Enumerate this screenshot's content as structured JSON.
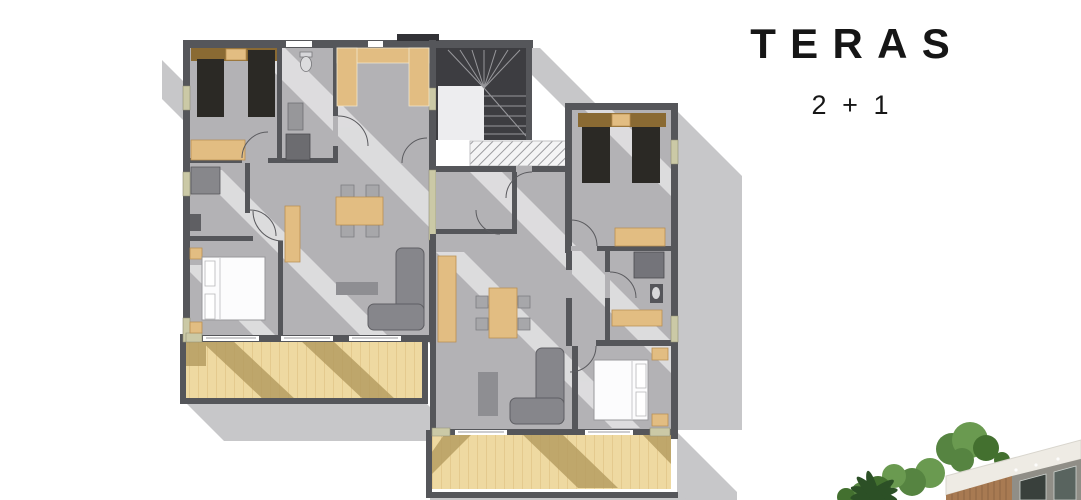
{
  "header": {
    "title": "TERAS",
    "subtitle": "2 + 1"
  },
  "colors": {
    "ink": "#161616",
    "wall": "#55565a",
    "walldark": "#323236",
    "floor": "#b3b2b5",
    "shadow": "#c7c7c9",
    "stair": "#3d3d41",
    "landing": "#ededef",
    "wood": "#e2bd82",
    "wooddark": "#b98f52",
    "headboard": "#8a6a33",
    "terrace": "#eed9a1",
    "terrline": "#d9ba7c",
    "terrpatch": "#b39a5e",
    "bed": "#2b2925",
    "sill": "#cbc9a6",
    "sofa": "#86868b",
    "sofadark": "#5f5f64",
    "hatchline": "#9b9b9f",
    "leaf1": "#568441",
    "leaf2": "#43702f",
    "leaf3": "#6a9a50",
    "palm": "#2c5026",
    "fascia": "#eeebe4",
    "slat": "#a87a52",
    "bwall": "#908e87",
    "glass": "#39403c",
    "glass2": "#59645f"
  }
}
